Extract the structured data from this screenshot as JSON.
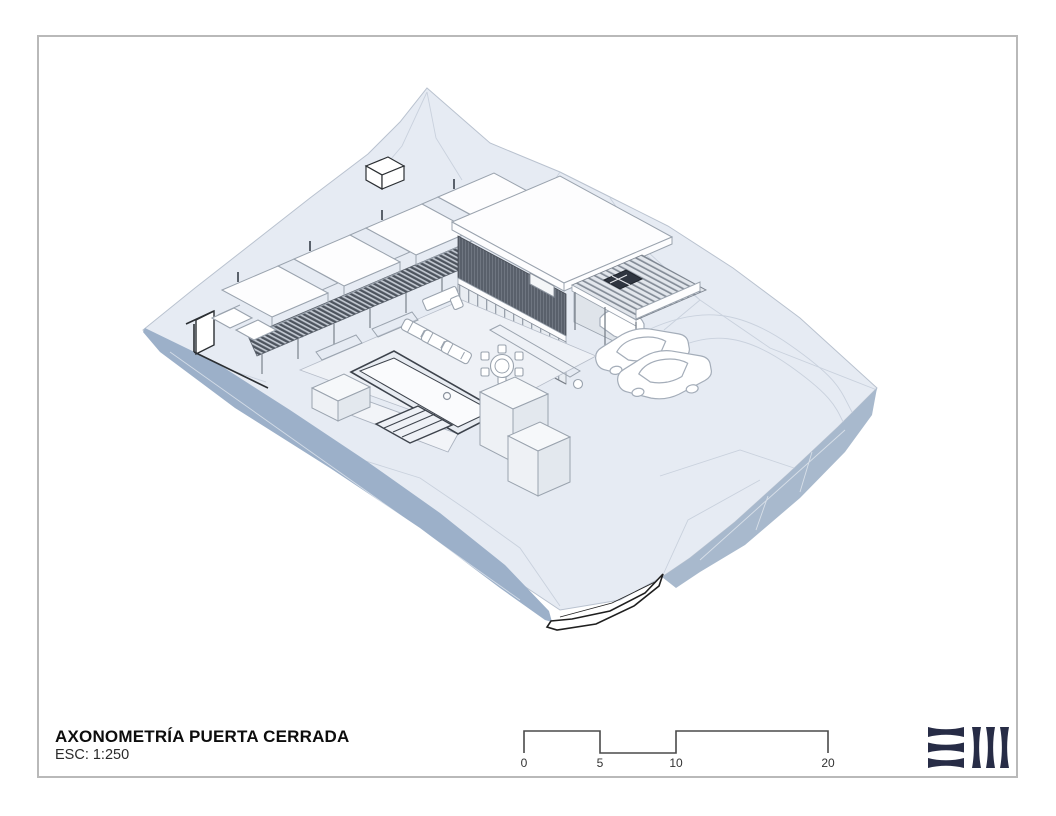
{
  "title_block": {
    "title": "AXONOMETRÍA PUERTA CERRADA",
    "scale": "ESC: 1:250"
  },
  "scale_bar": {
    "labels": [
      "0",
      "5",
      "10",
      "20"
    ]
  },
  "logo": {
    "color": "#272c46"
  },
  "colors": {
    "border": "#b9b9b9",
    "terrain_top": "#e6ebf3",
    "slope_left": "#9cb0c9",
    "cliff_right": "#a8b9cd",
    "screen_dark": "#59606b",
    "text": "#0d0d0d"
  }
}
